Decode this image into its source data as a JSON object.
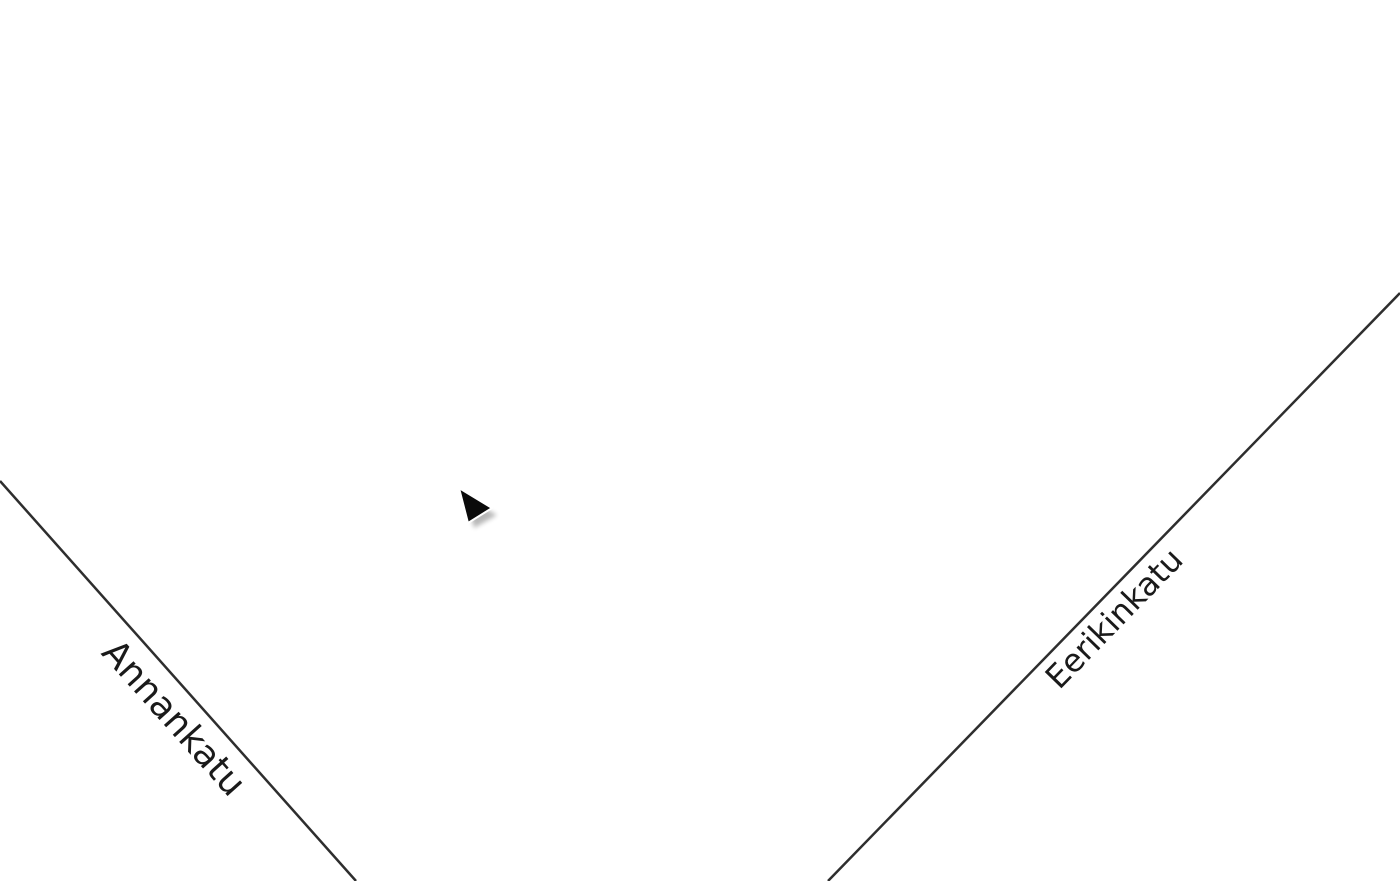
{
  "scene": {
    "title": "building-floorplan-isometric",
    "streets": [
      {
        "name": "Annankatu",
        "side": "southwest"
      },
      {
        "name": "Eerikinkatu",
        "side": "southeast"
      }
    ],
    "highlight": {
      "name": "highlighted-unit",
      "color": "#a81117"
    },
    "cursor": {
      "type": "pointer-triangle",
      "color": "#0a0a0a"
    },
    "colors": {
      "background": "#ffffff",
      "floor": "#c4c4c4",
      "wall": "#8c8c8c",
      "wallDark": "#6f6f6f",
      "charcoal": "#333638",
      "base": "#4e4e4e",
      "baseDark": "#1c1013",
      "baseLight": "#9a9a9a",
      "highlight": "#a81117",
      "highlightWall": "#7c0c10",
      "edgeDark": "#1c1c1c",
      "edgeLight": "#a0a0a0",
      "courtyard": "#ffffff",
      "streetLine": "#2e2e2e",
      "labelText": "#1a1a1a"
    }
  }
}
